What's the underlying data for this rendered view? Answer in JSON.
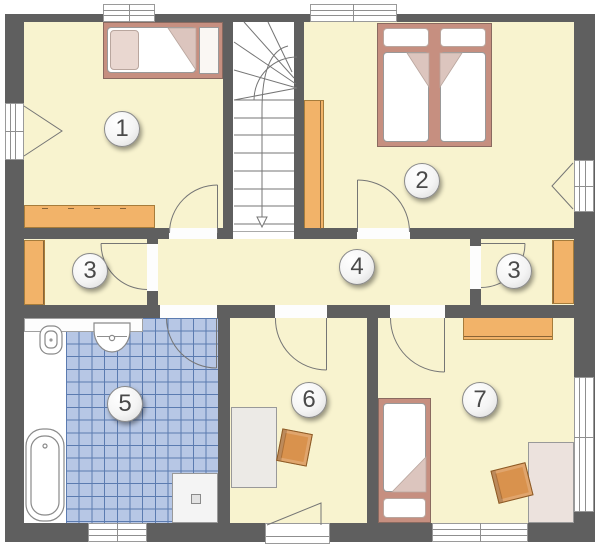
{
  "plan_title": "Obergeschoss Grundriss",
  "rooms": [
    {
      "id": "room-1",
      "number": "1"
    },
    {
      "id": "room-2",
      "number": "2"
    },
    {
      "id": "closet-left",
      "number": "3"
    },
    {
      "id": "hallway",
      "number": "4"
    },
    {
      "id": "closet-right",
      "number": "3"
    },
    {
      "id": "bathroom",
      "number": "5"
    },
    {
      "id": "room-6",
      "number": "6"
    },
    {
      "id": "room-7",
      "number": "7"
    }
  ],
  "colors": {
    "wall": "#5f5f5f",
    "floor": "#f8f3cf",
    "stair_floor": "#ffffff",
    "tile_fill": "#b7c7e5",
    "tile_grid": "#5b7bb0",
    "orange": "#f2b369",
    "orange_border": "#a67c3b",
    "bed_frame": "#c68f80",
    "bed_frame_border": "#8a6a60",
    "mattress_border": "#999999",
    "pillow": "#e9d7d0",
    "desk_gray": "#eceae6",
    "desk_pink": "#ece2dd",
    "chair": "#d9924d",
    "chair_border": "#8a5a28",
    "line": "#757575",
    "badge_text": "#4a4a4a"
  }
}
